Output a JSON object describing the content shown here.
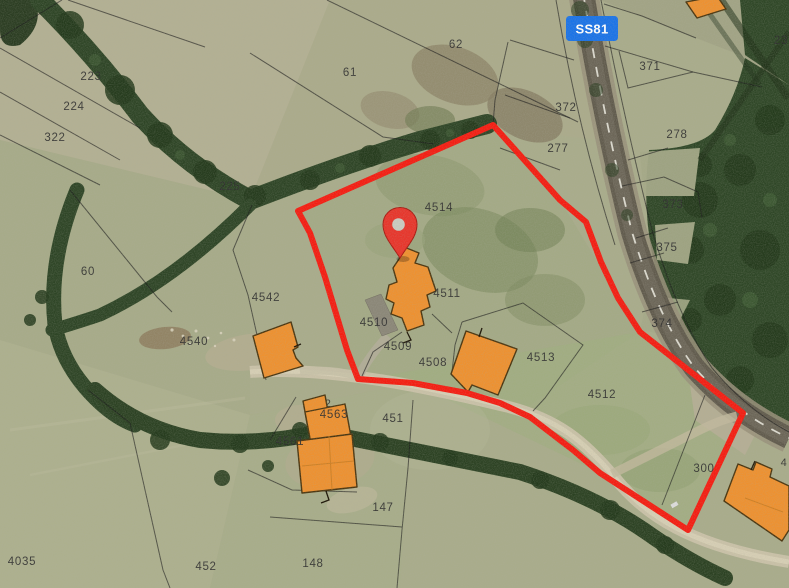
{
  "map": {
    "view": "satellite-cadastral",
    "road_badge": {
      "label": "SS81",
      "bg": "#1a73e8",
      "fg": "#ffffff"
    },
    "marker": {
      "kind": "location-pin",
      "fill": "#e8352b",
      "hole": "#cbccc2"
    },
    "selected_boundary_color": "#f51d12",
    "palette": {
      "grass": "#a9ac8b",
      "forest": "#2e4526",
      "road": "#615b4d",
      "dirt_path": "#cbc3aa",
      "building": "#ee9130",
      "building_outline": "#4a350f",
      "parcel_line": "#1a1a1a",
      "label": "#2e2e2e"
    },
    "parcel_labels": [
      {
        "text": "223"
      },
      {
        "text": "224"
      },
      {
        "text": "322"
      },
      {
        "text": "225"
      },
      {
        "text": "60"
      },
      {
        "text": "61"
      },
      {
        "text": "62"
      },
      {
        "text": "371"
      },
      {
        "text": "372"
      },
      {
        "text": "277"
      },
      {
        "text": "278"
      },
      {
        "text": "23"
      },
      {
        "text": "373"
      },
      {
        "text": "375"
      },
      {
        "text": "374"
      },
      {
        "text": "4514"
      },
      {
        "text": "4511"
      },
      {
        "text": "4509"
      },
      {
        "text": "4508"
      },
      {
        "text": "4513"
      },
      {
        "text": "4512"
      },
      {
        "text": "4542"
      },
      {
        "text": "4540"
      },
      {
        "text": "4561"
      },
      {
        "text": "4563"
      },
      {
        "text": "451"
      },
      {
        "text": "147"
      },
      {
        "text": "148"
      },
      {
        "text": "452"
      },
      {
        "text": "4035"
      },
      {
        "text": "300"
      }
    ],
    "partial_labels": [
      {
        "text": "4510"
      },
      {
        "text": "4562"
      },
      {
        "text": "4"
      }
    ]
  }
}
